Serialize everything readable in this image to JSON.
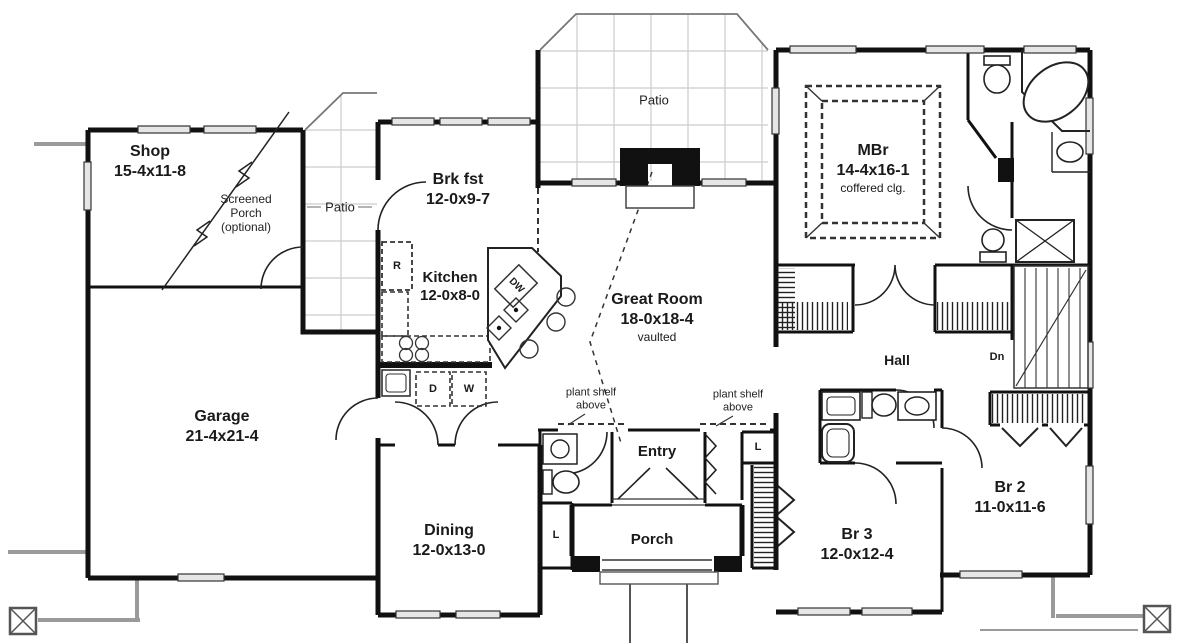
{
  "rooms": {
    "shop": {
      "name": "Shop",
      "dims": "15-4x11-8"
    },
    "screened_porch": {
      "line1": "Screened",
      "line2": "Porch",
      "line3": "(optional)"
    },
    "patio_left": {
      "name": "Patio"
    },
    "patio_top": {
      "name": "Patio"
    },
    "brkfst": {
      "name": "Brk fst",
      "dims": "12-0x9-7"
    },
    "kitchen": {
      "name": "Kitchen",
      "dims": "12-0x8-0"
    },
    "great_room": {
      "name": "Great Room",
      "dims": "18-0x18-4",
      "note": "vaulted"
    },
    "mbr": {
      "name": "MBr",
      "dims": "14-4x16-1",
      "note": "coffered clg."
    },
    "garage": {
      "name": "Garage",
      "dims": "21-4x21-4"
    },
    "dining": {
      "name": "Dining",
      "dims": "12-0x13-0"
    },
    "entry": {
      "name": "Entry"
    },
    "porch": {
      "name": "Porch"
    },
    "hall": {
      "name": "Hall"
    },
    "br3": {
      "name": "Br 3",
      "dims": "12-0x12-4"
    },
    "br2": {
      "name": "Br 2",
      "dims": "11-0x11-6"
    }
  },
  "annotations": {
    "plant_shelf_left": {
      "line1": "plant shelf",
      "line2": "above"
    },
    "plant_shelf_right": {
      "line1": "plant shelf",
      "line2": "above"
    },
    "stairs_down": "Dn",
    "refrigerator": "R",
    "dishwasher": "DW",
    "dryer": "D",
    "washer": "W",
    "linen_entry": "L",
    "linen_dining": "L"
  },
  "colors": {
    "wall": "#111111",
    "line": "#333333",
    "site": "#9a9a9a",
    "patio_grid": "#cccccc",
    "text": "#1a1a1a"
  }
}
